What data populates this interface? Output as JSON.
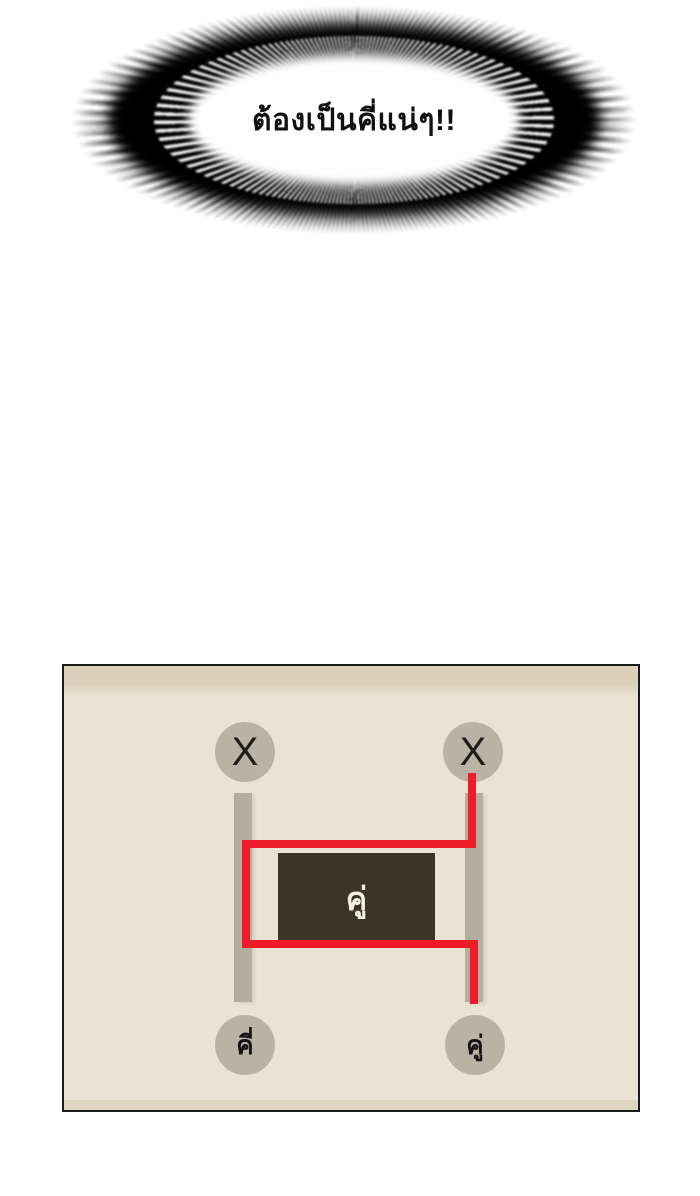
{
  "page": {
    "background_color": "#ffffff"
  },
  "speech_burst": {
    "text": "ต้องเป็นคี่แน่ๆ!!",
    "colors": {
      "rays": "#000000",
      "inner": "#ffffff",
      "text": "#111111"
    }
  },
  "ladder_panel": {
    "colors": {
      "background": "#eae3d3",
      "top_band": "#dcd2bc",
      "bottom_band": "#ded5c0",
      "border": "#1b1b1b",
      "node_fill": "#b9b3a5",
      "rail": "#b4ae9f",
      "path_red": "#ed1c29",
      "box_fill": "#3a3429",
      "box_text": "#f3efe3",
      "node_text": "#141414"
    },
    "top_nodes": [
      {
        "label": "X"
      },
      {
        "label": "X"
      }
    ],
    "bottom_nodes": [
      {
        "label": "คี่"
      },
      {
        "label": "คู่"
      }
    ],
    "center_box": {
      "label": "คู่"
    }
  }
}
